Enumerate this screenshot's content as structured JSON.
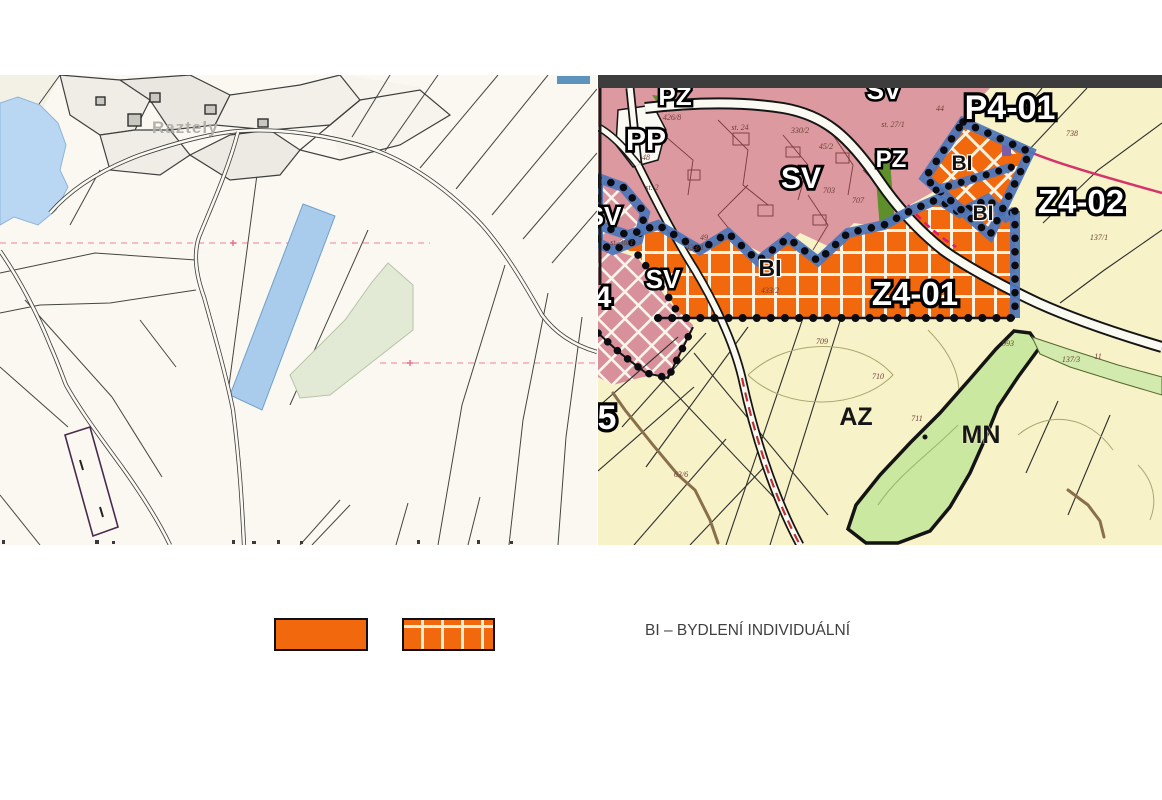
{
  "left_map": {
    "village_label": "Raztely"
  },
  "right_map": {
    "area_labels": [
      {
        "id": "pz-top",
        "text": "PZ"
      },
      {
        "id": "sv-top",
        "text": "SV"
      },
      {
        "id": "p4-01",
        "text": "P4-01"
      },
      {
        "id": "pp",
        "text": "PP"
      },
      {
        "id": "sv-main",
        "text": "SV"
      },
      {
        "id": "pz-mid",
        "text": "PZ"
      },
      {
        "id": "z4-02",
        "text": "Z4-02"
      },
      {
        "id": "sv-left-edge",
        "text": "SV"
      },
      {
        "id": "sv-lower",
        "text": "SV"
      },
      {
        "id": "z4-01",
        "text": "Z4-01"
      },
      {
        "id": "code-4",
        "text": "4"
      },
      {
        "id": "code-5",
        "text": "5"
      },
      {
        "id": "bi-upper",
        "text": "BI"
      },
      {
        "id": "bi-lower",
        "text": "BI"
      },
      {
        "id": "bi-main",
        "text": "BI"
      },
      {
        "id": "az",
        "text": "AZ"
      },
      {
        "id": "mn",
        "text": "MN"
      }
    ],
    "parcel_numbers": [
      "44",
      "st. 27/1",
      "330/2",
      "45/2",
      "st. 24",
      "426/8",
      "48",
      "st. 2",
      "st. 38/1",
      "433/1",
      "49",
      "707",
      "703",
      "738",
      "137/1",
      "433/2",
      "709",
      "710",
      "711",
      "993",
      "137/3",
      "11",
      "63/6"
    ]
  },
  "legend": {
    "label": "BI – BYDLENÍ INDIVIDUÁLNÍ"
  },
  "colors": {
    "zone_orange": "#F2690D",
    "zone_pink": "#DC99A0",
    "plan_yellow": "#F7F2C8",
    "boundary_blue": "#4F76B8",
    "water_blue": "#A9CBEC",
    "green_mn": "#CBE8A0"
  }
}
